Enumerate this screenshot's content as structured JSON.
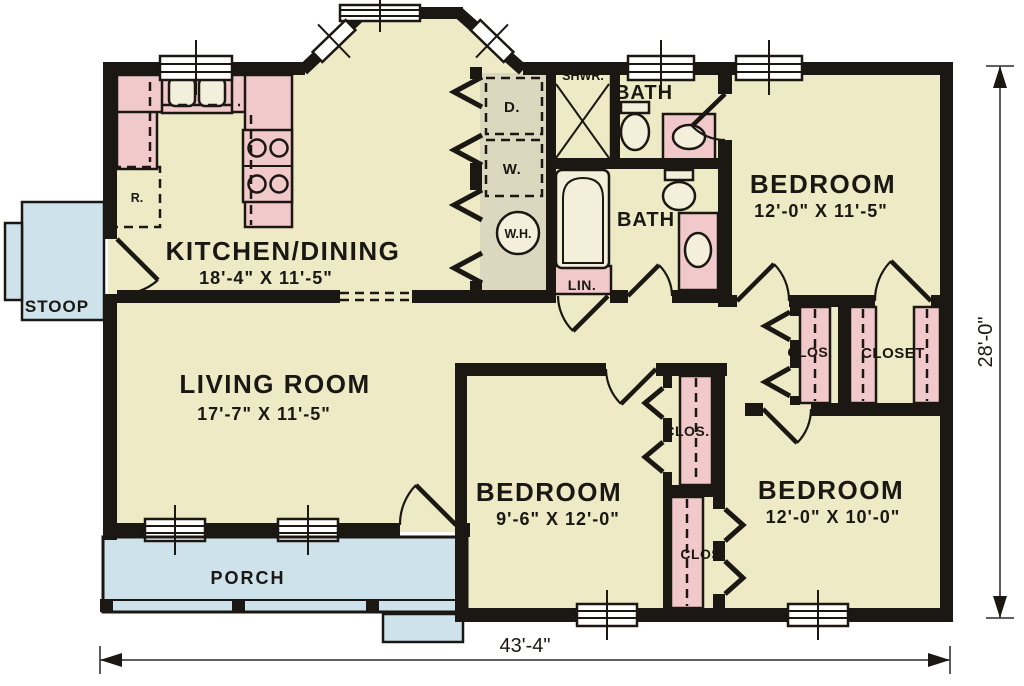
{
  "rooms": {
    "kitchen_dining": {
      "label": "KITCHEN/DINING",
      "dims": "18'-4\" X 11'-5\""
    },
    "living_room": {
      "label": "LIVING ROOM",
      "dims": "17'-7\" X 11'-5\""
    },
    "bedroom_right": {
      "label": "BEDROOM",
      "dims": "12'-0\" X 11'-5\""
    },
    "bedroom_middle": {
      "label": "BEDROOM",
      "dims": "9'-6\" X 12'-0\""
    },
    "bedroom_bottom_right": {
      "label": "BEDROOM",
      "dims": "12'-0\" X 10'-0\""
    },
    "bath_upper": {
      "label": "BATH"
    },
    "bath_lower": {
      "label": "BATH"
    },
    "stoop": {
      "label": "STOOP"
    },
    "porch": {
      "label": "PORCH"
    }
  },
  "closets": {
    "hall_closet": "CLOS.",
    "bedroom_closet": "CLOSET",
    "middle_closet_upper": "CLOS.",
    "middle_closet_lower": "CLOS.",
    "linen": "LIN."
  },
  "fixtures": {
    "dryer": "D.",
    "washer": "W.",
    "water_heater": "W.H.",
    "shower": "SHWR.",
    "refrigerator": "R."
  },
  "dimensions": {
    "overall_width": "43'-4\"",
    "overall_depth": "28'-0\""
  },
  "colors": {
    "floor": "#EEEAC6",
    "cabinetry": "#F2C9CB",
    "porch": "#CDE2EB",
    "utility": "#DCD8C0",
    "appliance": "#D2CEB6",
    "fixture": "#F3EFDA",
    "wall": "#1B1713",
    "background": "#FFFFFF"
  }
}
